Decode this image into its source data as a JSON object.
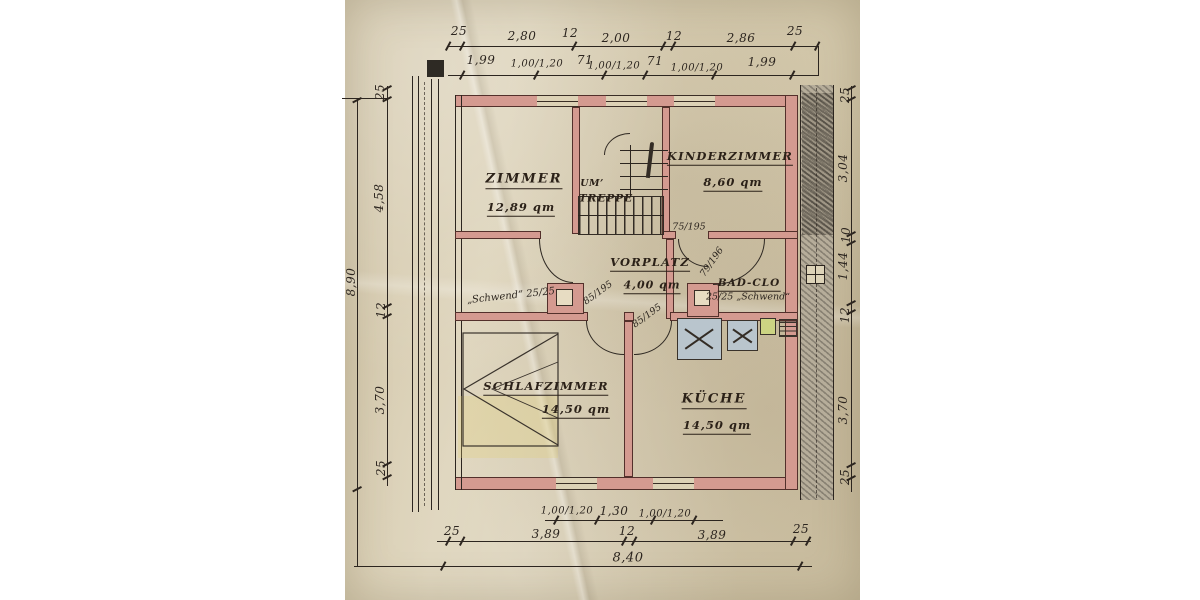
{
  "rooms": {
    "zimmer": {
      "label": "ZIMMER",
      "area": "12,89 qm"
    },
    "treppe": {
      "prefix": "UM’",
      "label": "TREPPE"
    },
    "kinderzimmer": {
      "label": "KINDERZIMMER",
      "area": "8,60 qm"
    },
    "vorplatz": {
      "label": "VORPLATZ",
      "area": "4,00 qm"
    },
    "bad": {
      "label": "BAD-CLO"
    },
    "schlafzimmer": {
      "label": "SCHLAFZIMMER",
      "area": "14,50 qm"
    },
    "kueche": {
      "label": "KÜCHE",
      "area": "14,50 qm"
    }
  },
  "dimensions": {
    "top_outer": [
      "25",
      "2,80",
      "12",
      "2,00",
      "12",
      "2,86",
      "25"
    ],
    "top_inner": [
      "1,99",
      "1,00/1,20",
      "71",
      "1,00/1,20",
      "71",
      "1,00/1,20",
      "1,99"
    ],
    "left_total": "8,90",
    "left": [
      "25",
      "4,58",
      "12",
      "3,70",
      "25"
    ],
    "right": [
      "25",
      "3,04",
      "10",
      "1,44",
      "12",
      "3,70",
      "25"
    ],
    "bottom_windows": [
      "1,00/1,20",
      "1,30",
      "1,00/1,20"
    ],
    "bottom": [
      "25",
      "3,89",
      "12",
      "3,89",
      "25"
    ],
    "bottom_total": "8,40"
  },
  "annotations": {
    "door_kinderzimmer": "75/195",
    "door_bad": "79/196",
    "door_schlafzimmer": "85/195",
    "door_kueche": "85/195",
    "chimney_left": "„Schwend“ 25/25",
    "chimney_right": "25/25 „Schwend“"
  },
  "colors": {
    "paper": "#d8cdb1",
    "wall_fill": "#d49a90",
    "ink": "#2c251f",
    "pencil_hatch": "#b6ad9a",
    "kitchen_fixture": "#b9c5cd",
    "accent_green": "#ccd483",
    "tint_yellow": "#e1d278"
  }
}
